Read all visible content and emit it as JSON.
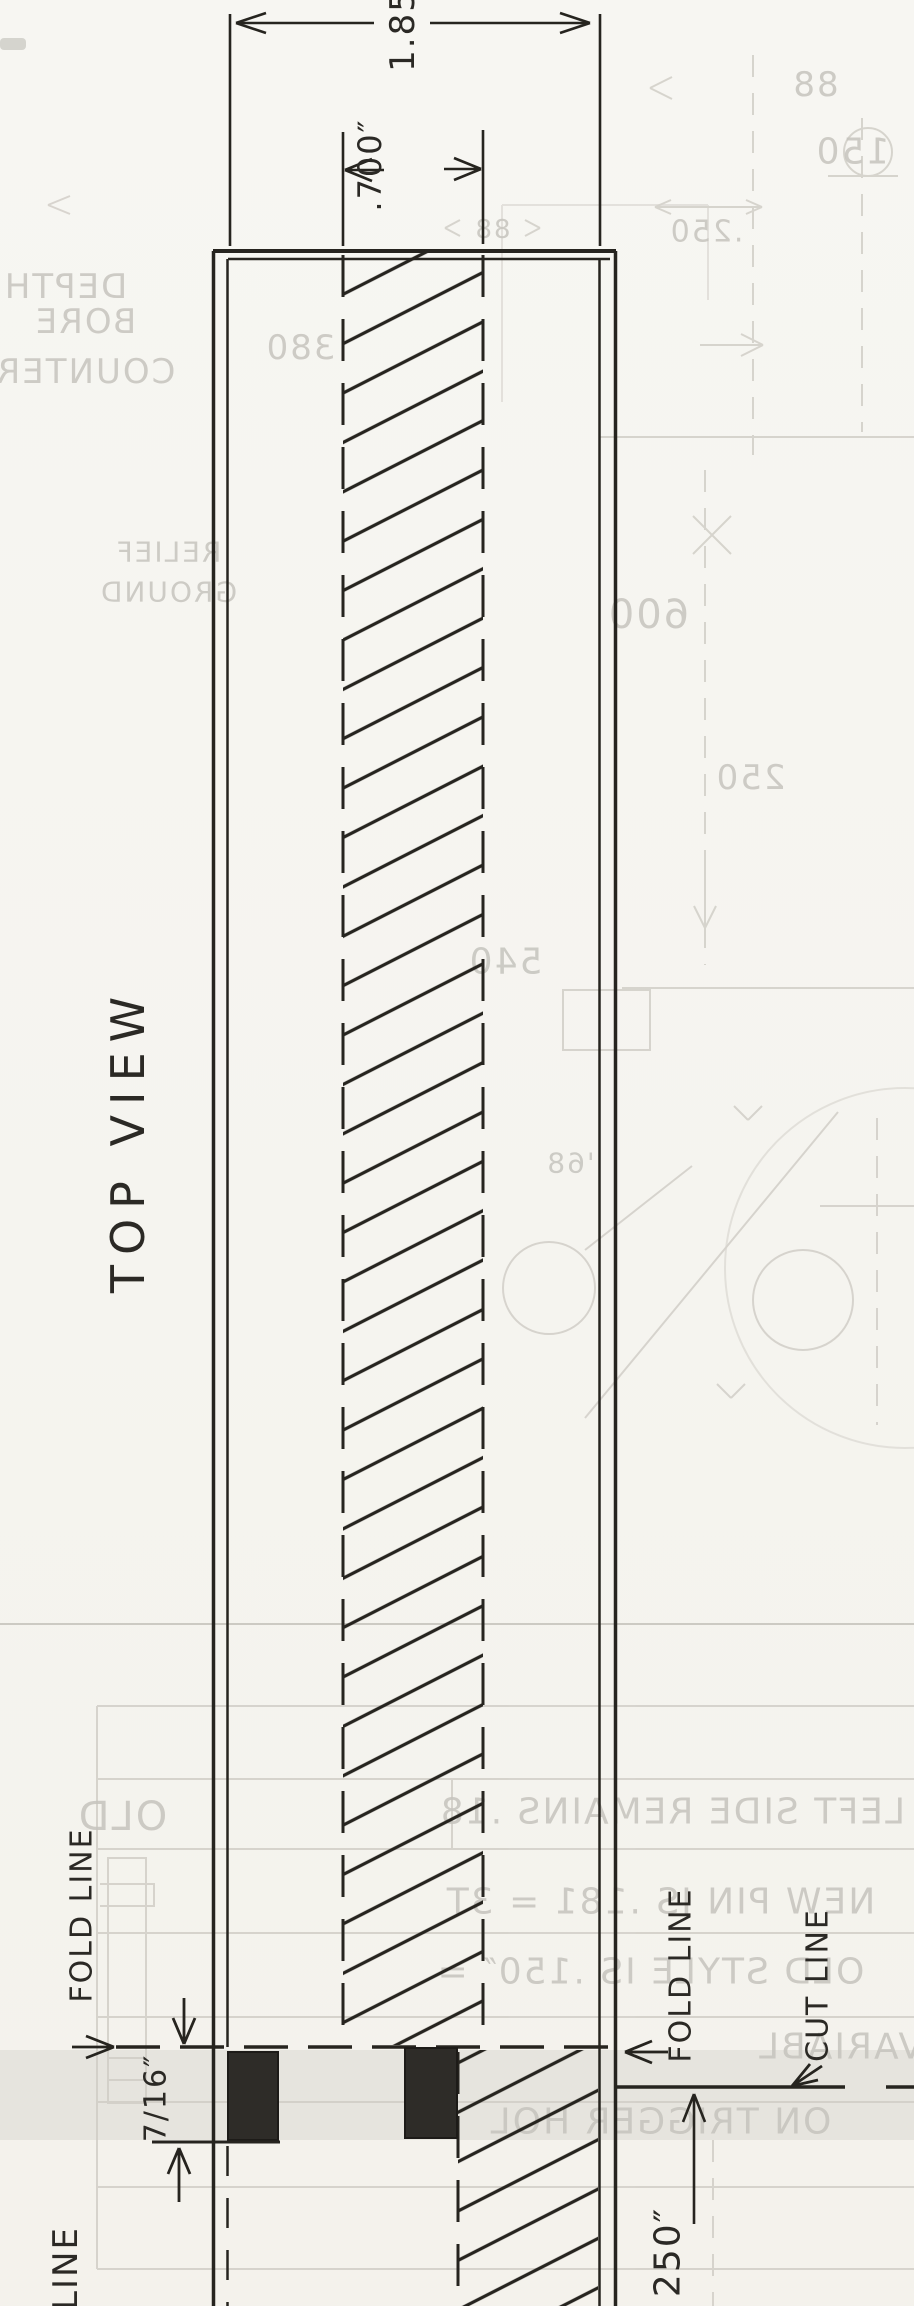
{
  "drawing": {
    "view_label": "TOP VIEW",
    "dimensions": {
      "overall_width": "1.85",
      "slot_width": ".700″",
      "notch_depth": "7/16″",
      "edge_offset": "250″"
    },
    "annotations": {
      "fold_line_left": "FOLD LINE",
      "fold_line_right": "FOLD LINE",
      "cut_line": "CUT LINE",
      "partial_label": "LINE"
    }
  },
  "bleed_through": {
    "counter_bore": {
      "line1": "DEPTH",
      "line2": "BORE",
      "line3": "COUNTER"
    },
    "relief": {
      "line1": "RELIEF",
      "line2": "GROUND"
    },
    "notes_table": {
      "old": "OLD",
      "row1": "LEFT SIDE REMAINS .18",
      "row2": "NEW PIN IS .181 = 3T",
      "row3": "OLD STYLE IS .150″ =",
      "row4": "VARIABL",
      "row5": "ON TRIGGER HOL"
    },
    "numbers": {
      "n88_top": "88",
      "n150": "150",
      "n250_dim": ".250",
      "n600": "600",
      "n250_mid": "250",
      "n540": "540",
      "n68": "'68",
      "n380": "380",
      "n88_strip": "88"
    }
  }
}
